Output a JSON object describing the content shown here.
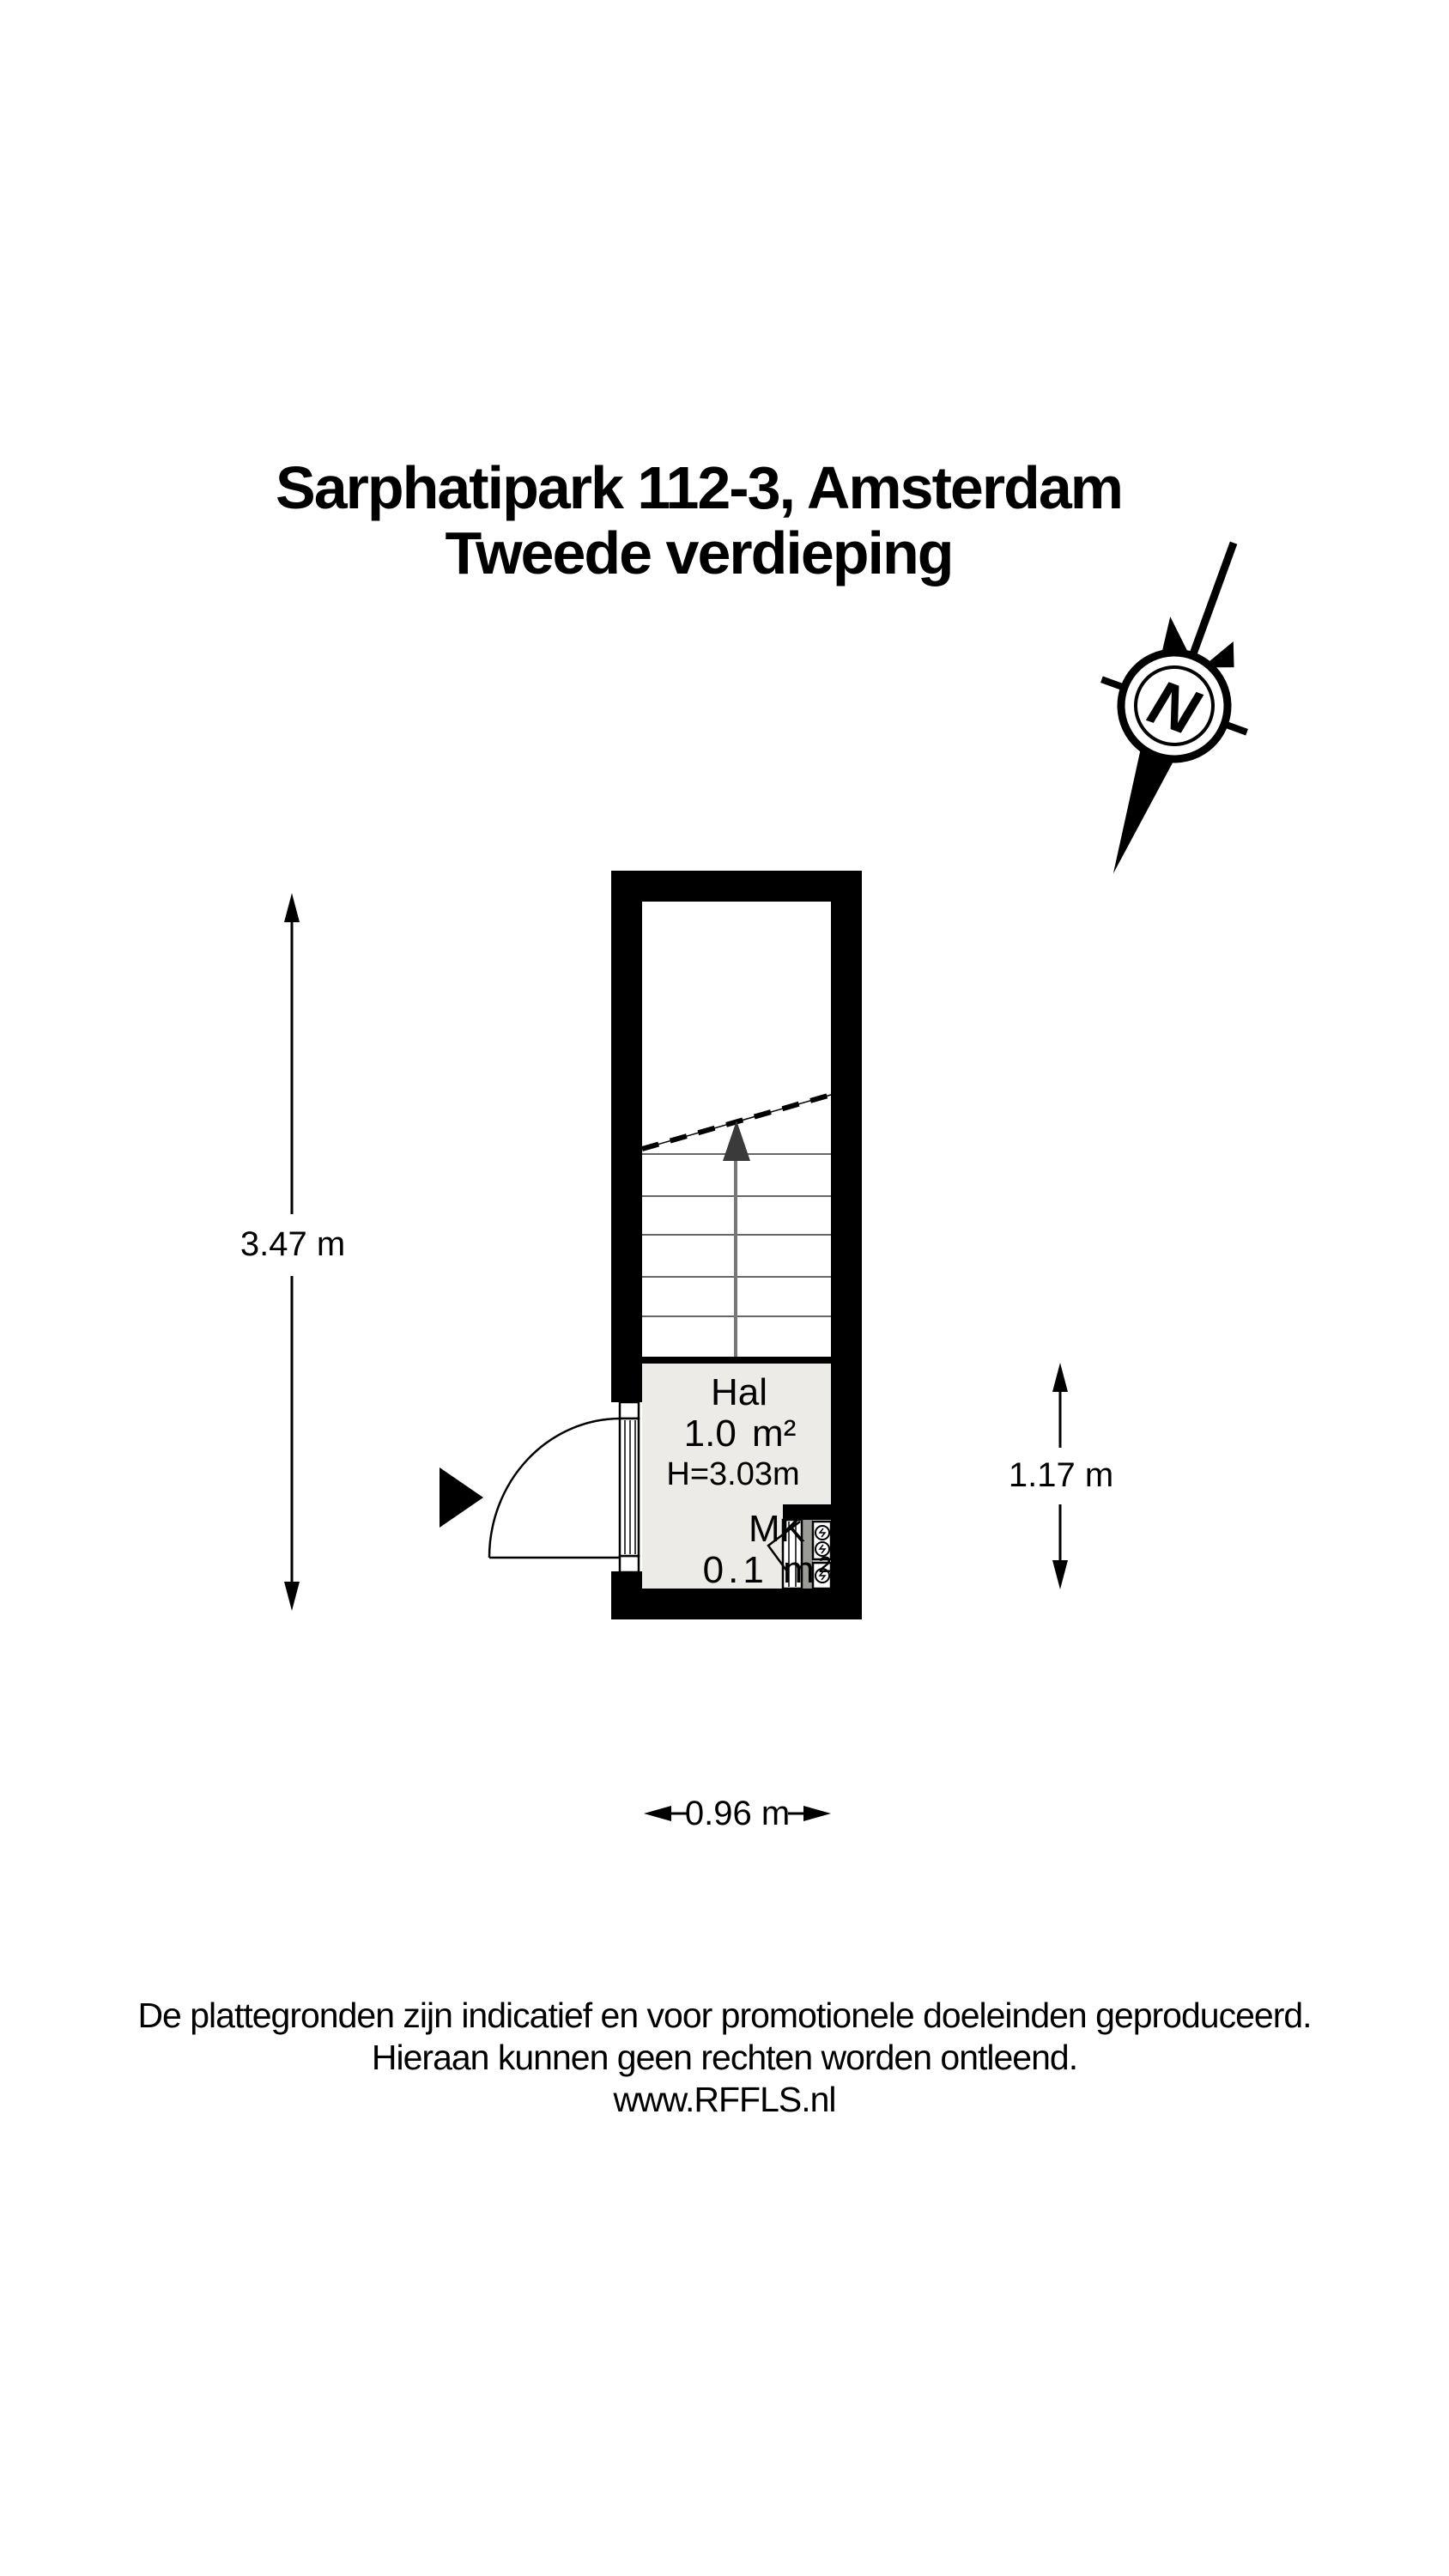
{
  "title": {
    "line1": "Sarphatipark 112-3, Amsterdam",
    "line2": "Tweede verdieping"
  },
  "compass": {
    "label": "N",
    "icon": "north-compass-icon"
  },
  "plan": {
    "rooms": [
      {
        "name": "Hal",
        "area": "1.0 m²",
        "ceiling_height": "H=3.03m"
      },
      {
        "name": "MK",
        "area": "0.1 m²"
      }
    ],
    "features": [
      "staircase-up-arrow",
      "entrance-door-swing",
      "meter-cupboard"
    ]
  },
  "dimensions": {
    "total_height": "3.47 m",
    "hall_height": "1.17 m",
    "hall_width": "0.96 m"
  },
  "footer": {
    "line1": "De plattegronden zijn indicatief en voor promotionele doeleinden geproduceerd.",
    "line2": "Hieraan kunnen geen rechten worden ontleend.",
    "line3": "www.RFFLS.nl"
  },
  "colors": {
    "wall": "#000000",
    "hall_fill": "#edebe7",
    "stair_lines": "#666666",
    "stair_arrow": "#3a3a3a",
    "meter_strip": "#9b9b95"
  }
}
